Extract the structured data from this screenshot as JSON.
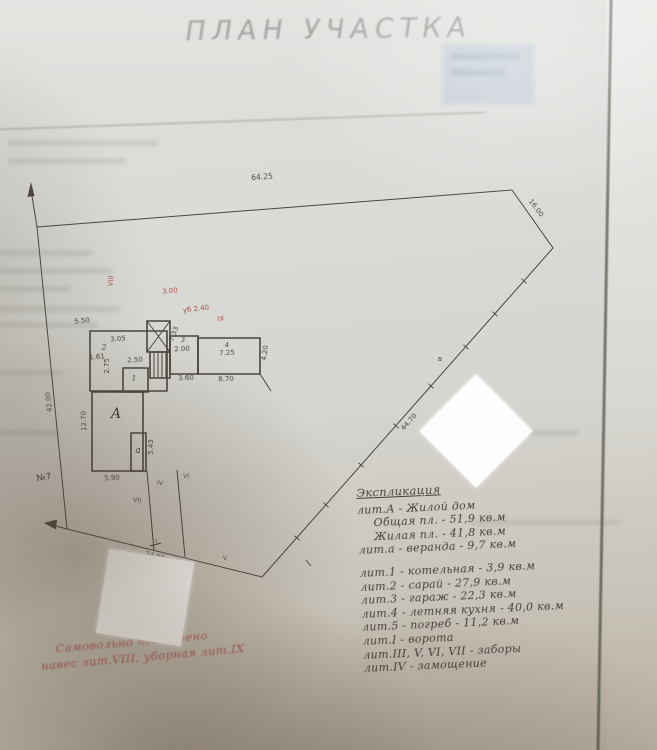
{
  "title": "ПЛАН УЧАСТКА",
  "dims": {
    "top": "64.25",
    "right": "16.00",
    "diag": "44.70",
    "left": "42.00",
    "bottom": "24.65",
    "house_h": "12.70",
    "house_w": "5.90",
    "annex_h": "5.43",
    "shed_w_top": "5.50",
    "shed_inner": "3.05",
    "shed_d1": "1.61",
    "shed_d2": "2.75",
    "shed_d3": "7.33",
    "boiler_w": "2.50",
    "garage_w": "2.00",
    "kitchen_a": "7.25",
    "kitchen_w": "8.70",
    "kitchen_d1": "3.60",
    "kitchen_h": "4.20"
  },
  "bld": {
    "house": "А",
    "annex": "а",
    "shed": "2",
    "boiler": "1",
    "garage": "3",
    "kitchen": "4"
  },
  "marks": {
    "plot_no": "№7",
    "pt": "в",
    "f1": "VII",
    "f2": "IV",
    "f3": "VI",
    "f4": "I",
    "f5": "V"
  },
  "red": {
    "m1": "VIII",
    "d1": "3.00",
    "note": "уб 2.40",
    "m2": "IX",
    "note1": "Самовольно построено",
    "note2": "навес лит.VIII, уборная лит.IX"
  },
  "explication": {
    "title": "Экспликация",
    "lines": [
      {
        "text": "лит.А - Жилой дом"
      },
      {
        "text": "Общая пл. - 51,9 кв.м",
        "indent": true
      },
      {
        "text": "Жилая пл. - 41,8 кв.м",
        "indent": true
      },
      {
        "text": "лит.а - веранда - 9,7 кв.м"
      },
      {
        "text": "лит.1 - котельная - 3,9 кв.м",
        "gap": true
      },
      {
        "text": "лит.2 - сарай - 27,9 кв.м"
      },
      {
        "text": "лит.3 - гараж - 22,3 кв.м"
      },
      {
        "text": "лит.4 - летняя кухня - 40,0 кв.м"
      },
      {
        "text": "лит.5 - погреб - 11,2 кв.м"
      },
      {
        "text": "лит.I - ворота"
      },
      {
        "text": "лит.III, V, VI, VII - заборы"
      },
      {
        "text": "лит.IV - замощение"
      }
    ]
  }
}
